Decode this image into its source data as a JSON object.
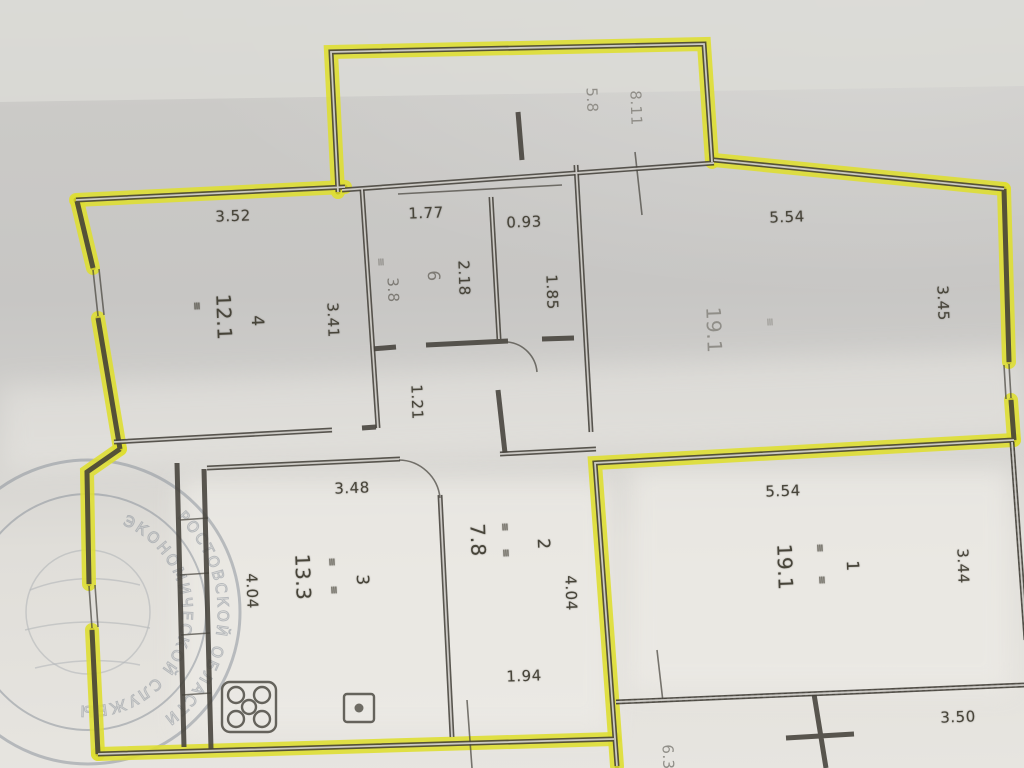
{
  "colors": {
    "highlighter": "#dede33",
    "highlighter_dark": "#b4ae1c",
    "pencil": "#44413a",
    "paper": "#d2d1cd",
    "stamp": "#868e98"
  },
  "plan": {
    "balcony": {
      "dim_a": "5.8",
      "dim_b": "8.11"
    },
    "room4": {
      "number": "4",
      "area": "12.1",
      "width": "3.52",
      "depth": "3.41"
    },
    "room6": {
      "number": "6",
      "area": "3.8",
      "width": "1.77",
      "depth": "2.18"
    },
    "wc": {
      "width": "0.93",
      "depth": "1.85"
    },
    "room_top_right": {
      "area": "19.1",
      "width": "5.54",
      "depth": "3.45"
    },
    "hall": {
      "dim": "1.21"
    },
    "room3": {
      "number": "3",
      "area": "13.3",
      "width": "3.48",
      "depth": "4.04"
    },
    "room2": {
      "number": "2",
      "area": "7.8",
      "depth": "4.04",
      "width": "1.94"
    },
    "room1": {
      "number": "1",
      "area": "19.1",
      "width": "5.54",
      "depth": "3.44"
    },
    "neighbor_bottom": {
      "dim": "3.50",
      "dim_cut": "6.3"
    },
    "equals_mark": "≡"
  },
  "stamp": {
    "arc_text_outer": "РОСТОВСКОЙ ОБЛАСТИ",
    "arc_text_inner": "ЭКОНОМИЧЕСКОЙ СЛУЖБЫ"
  }
}
